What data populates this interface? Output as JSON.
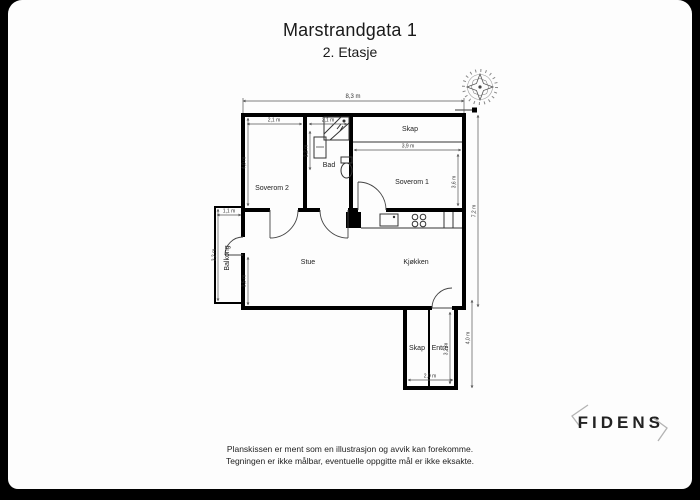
{
  "header": {
    "title": "Marstrandgata 1",
    "subtitle": "2. Etasje"
  },
  "plan": {
    "rooms": [
      {
        "label": "Soverom 2"
      },
      {
        "label": "Bad"
      },
      {
        "label": "Soverom 1"
      },
      {
        "label": "Skap"
      },
      {
        "label": "Stue"
      },
      {
        "label": "Kjøkken"
      },
      {
        "label": "Balkong"
      },
      {
        "label": "Skap"
      },
      {
        "label": "Entré"
      }
    ],
    "dimensions": {
      "total_width": "8,3 m",
      "soverom2_width": "2,1 m",
      "bad_width": "2,1 m",
      "soverom2_depth": "4,0 m",
      "bad_depth": "2,2 m",
      "soverom1_width": "3,9 m",
      "soverom1_depth": "3,6 m",
      "right_total": "7,2 m",
      "balkong_width": "1,1 m",
      "balkong_length": "3,2 m",
      "stue_wall": "3,5 m",
      "lower_right_total": "4,0 m",
      "entre_depth": "3,2 m",
      "entre_width": "2,0 m"
    },
    "icons": {
      "compass": "compass-rose-icon",
      "scale_bar": "scale-bar-icon"
    }
  },
  "footer": {
    "disclaimer_line1": "Planskissen er ment som en illustrasjon og avvik kan forekomme.",
    "disclaimer_line2": "Tegningen er ikke målbar, eventuelle oppgitte mål er ikke eksakte.",
    "brand": "FIDENS"
  }
}
